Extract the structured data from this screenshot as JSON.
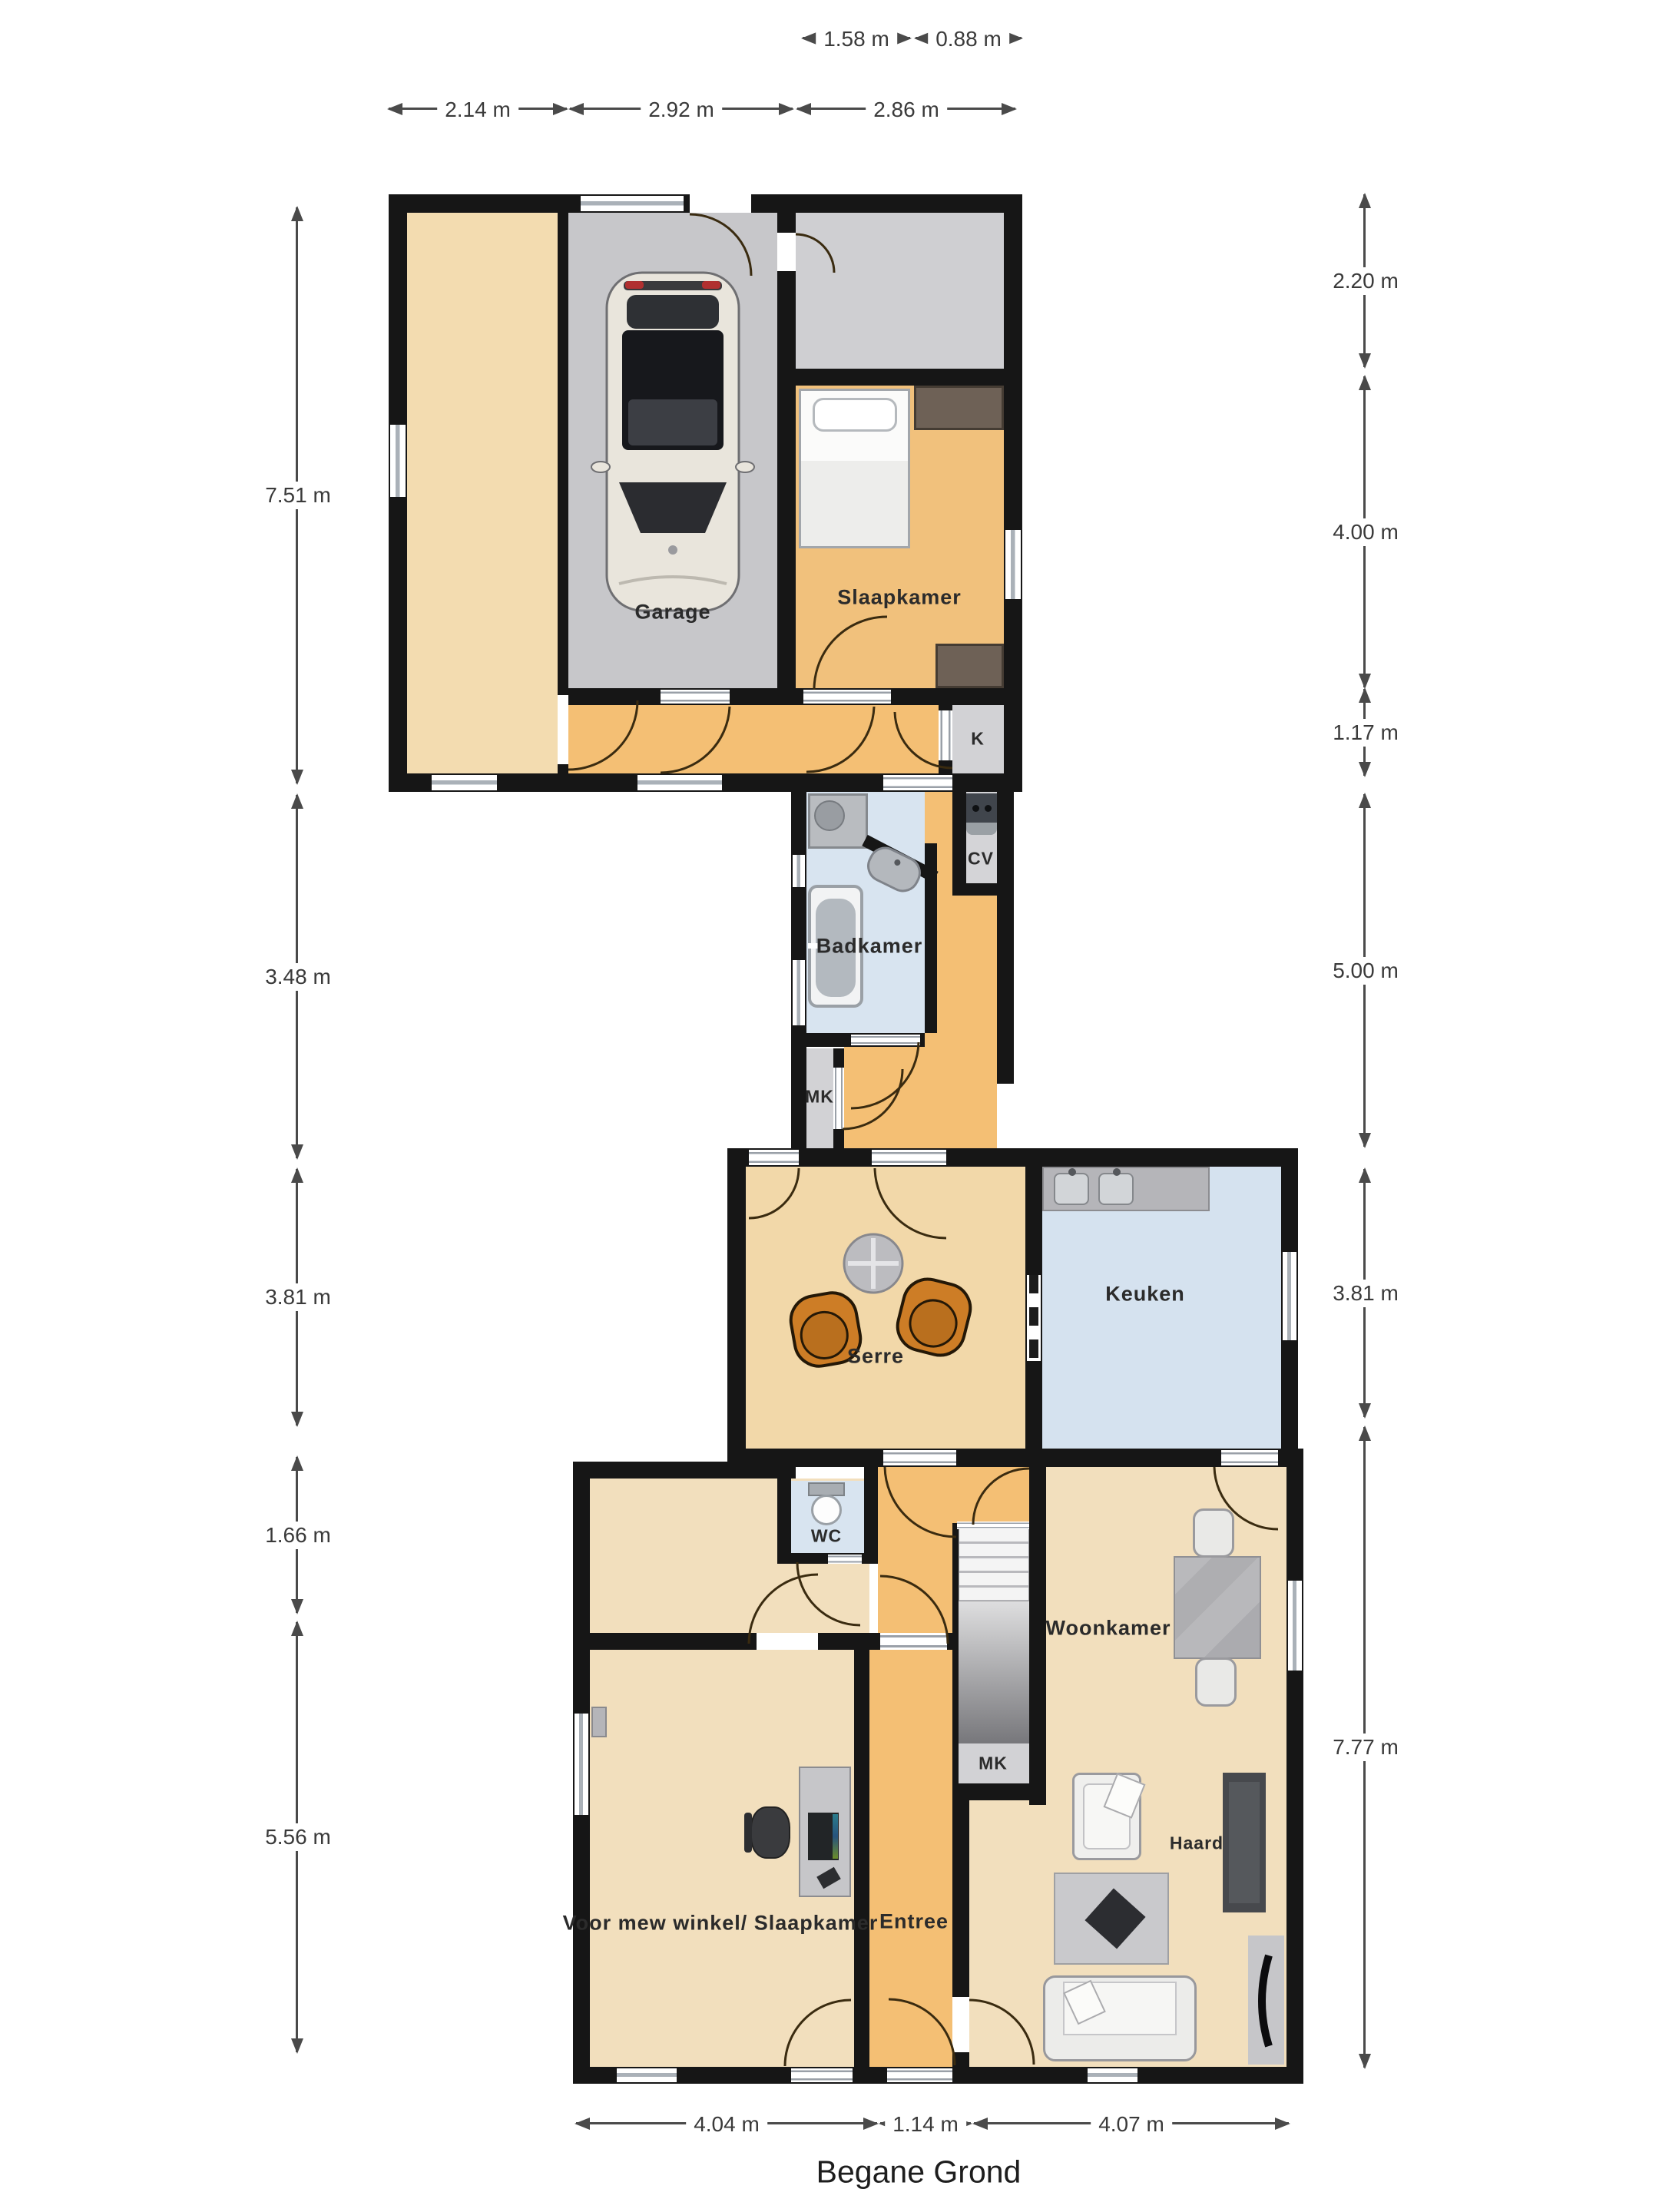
{
  "title": "Begane Grond",
  "rooms": {
    "garage": "Garage",
    "slaapkamer": "Slaapkamer",
    "k": "K",
    "cv": "CV",
    "badkamer": "Badkamer",
    "mk_upper": "MK",
    "serre": "Serre",
    "keuken": "Keuken",
    "wc": "WC",
    "woonkamer": "Woonkamer",
    "mk_lower": "MK",
    "haard": "Haard",
    "entree": "Entree",
    "shop": "Voor mew winkel/ Slaapkamer"
  },
  "dimensions": {
    "top_row": [
      {
        "label": "1.58 m"
      },
      {
        "label": "0.88 m"
      }
    ],
    "second_row": [
      {
        "label": "2.14 m"
      },
      {
        "label": "2.92 m"
      },
      {
        "label": "2.86 m"
      }
    ],
    "left": [
      {
        "label": "7.51 m"
      },
      {
        "label": "3.48 m"
      },
      {
        "label": "3.81 m"
      },
      {
        "label": "1.66 m"
      },
      {
        "label": "5.56 m"
      }
    ],
    "right": [
      {
        "label": "2.20 m"
      },
      {
        "label": "4.00 m"
      },
      {
        "label": "1.17 m"
      },
      {
        "label": "5.00 m"
      },
      {
        "label": "3.81 m"
      },
      {
        "label": "7.77 m"
      }
    ],
    "bottom": [
      {
        "label": "4.04 m"
      },
      {
        "label": "1.14 m"
      },
      {
        "label": "4.07 m"
      }
    ]
  },
  "colors": {
    "wall": "#161616",
    "garage_floor": "#c7c7ca",
    "storage_floor": "#cfcfd2",
    "bedroom_floor": "#f1c17c",
    "hallway_floor": "#f4bf74",
    "serre_floor": "#f2d8a9",
    "living_floor": "#f2dfbd",
    "cream_room_floor": "#f3dcb0",
    "bathroom_floor": "#d8e4f0",
    "kitchen_floor": "#d5e2ef",
    "closet_floor": "#d2d2d5",
    "chair_orange": "#cd7d26"
  }
}
